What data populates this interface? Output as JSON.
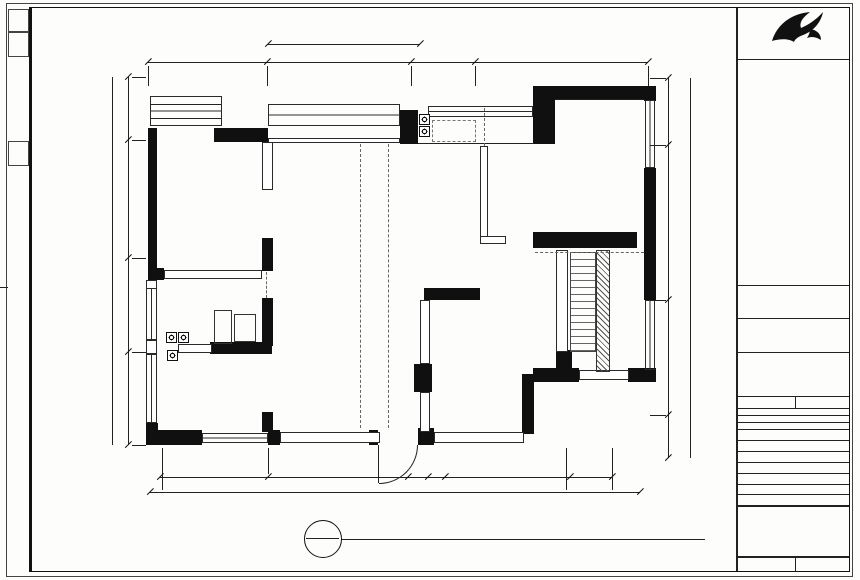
{
  "brand": {
    "name": "红牛装饰",
    "sub": "NANJING HONGNIU DECORATION ENGINEERING CO.,LTD"
  },
  "titleblock": {
    "review_label": "图纸会审 DRAWING REVIEW",
    "sign_label": "客户签字 CLIENT SIGN",
    "company_label": "设计单位 DESIGN COMPANY",
    "company_name": "南京红牛装饰有限公司",
    "company_address": "地址：龙蟠中路458号一楼",
    "company_phone": "电话：025-52328155",
    "project_label": "工程名称",
    "no_label": "图 号",
    "rows": [
      {
        "label": "图纸名称",
        "value": "原始结构图"
      },
      {
        "label": "工程地址",
        "value": ""
      },
      {
        "label": "制 图",
        "value": "红牛"
      },
      {
        "label": "设 计",
        "value": "红牛"
      },
      {
        "label": "审 核",
        "value": ""
      },
      {
        "label": "日 期",
        "value": ""
      },
      {
        "label": "比 例",
        "value": "1:70"
      }
    ],
    "notes_title": "注意事项",
    "notes": [
      "1.本图纸版权归本公司所有,未经许可不得翻印。",
      "2.施工前请核对现场实际尺寸。",
      "3.图中尺寸以现场实际放样为准。",
      "Estimate and work described direction site",
      "Estimate need date of decorate on site",
      "Drawings must be agreed hardcopy to perform"
    ],
    "footer_no_label": "图 号",
    "footer_no_value": "PL-888",
    "footer_date_label": "日 期",
    "footer_date_value": ""
  },
  "stamp": {
    "top": "P",
    "bottom": "PL-888"
  },
  "titlebar": {
    "title": "1F PLAN",
    "subtitle": "原始结构图",
    "scale": "SCALE: 1:70"
  },
  "dims": {
    "top": [
      "2873",
      "3730",
      "1586",
      "3780"
    ],
    "top2": "3006",
    "bottom": [
      "2850",
      "3730",
      "380",
      "230",
      "3373",
      "1893"
    ],
    "bottom_total": "12425",
    "left": [
      "1823",
      "3480",
      "1730",
      "2345"
    ],
    "left_total": "9600",
    "right": [
      "870",
      "3060",
      "3470",
      "1515"
    ],
    "right_total": "9070"
  },
  "plan": {
    "bay1": "CL:1600",
    "bay2": "D:600",
    "balcony": "YT:2230",
    "kwin1": "CL:340",
    "kwin2": "LD:1230",
    "bed2a": "CL:1600",
    "bed2b": "D:900",
    "living": "层高:2730",
    "beam_250": "梁:250",
    "beam_200": "梁:200",
    "beam_260": "梁:260",
    "lwin1a": "CL:1350",
    "lwin1b": "D:1000",
    "lwin2a": "CL:1560",
    "lwin2b": "D:900"
  }
}
